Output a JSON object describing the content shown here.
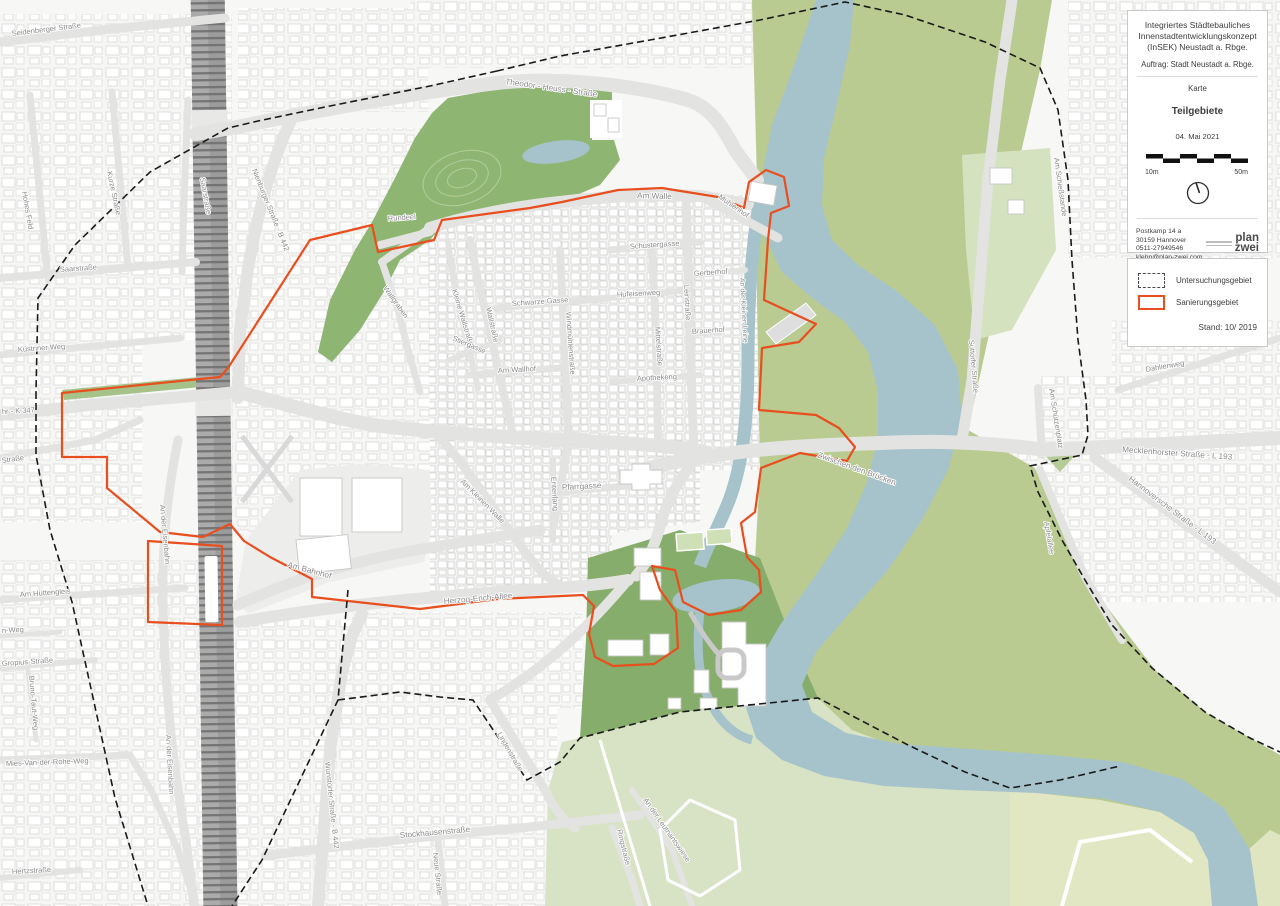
{
  "info_panel": {
    "title_line1": "Integriertes Städtebauliches",
    "title_line2": "Innenstadtentwicklungskonzept",
    "title_line3": "(InSEK) Neustadt a. Rbge.",
    "commission": "Auftrag: Stadt Neustadt a. Rbge.",
    "map_label": "Karte",
    "map_title": "Teilgebiete",
    "date": "04. Mai 2021",
    "scale_left": "10m",
    "scale_right": "50m",
    "address_line1": "Postkamp 14 a",
    "address_line2": "30159  Hannover",
    "address_line3": "0511-27949546",
    "address_line4": "klehn@plan-zwei.com",
    "logo_line1": "plan",
    "logo_line2": "zwei"
  },
  "legend": {
    "item1_label": "Untersuchungsgebiet",
    "item2_label": "Sanierungsgebiet",
    "status": "Stand: 10/ 2019"
  },
  "colors": {
    "sanierungsgebiet_red": "#e84e1e",
    "untersuchungsgebiet_black": "#1a1a1a",
    "park_green": "#8fb573",
    "floodplain_green": "#b9cb90",
    "pale_green": "#d8e3c5",
    "river_blue": "#a6c3cb",
    "street_gray": "#e3e3e2",
    "railway_gray": "#ababab"
  },
  "map": {
    "street_labels": [
      "Seidenberger Straße",
      "Hohes Feld",
      "Kurze Straße",
      "Saarstraße",
      "Saarstraße",
      "Nienburger Straße - B 442",
      "Theodor - Heuss - Straße",
      "Am Walle",
      "Mühlenhof",
      "Rundeel",
      "Wallgraben",
      "Kleine Wallstraße",
      "Wallstraße",
      "Stiergasse",
      "Schwarze Gasse",
      "Schustergasse",
      "Hufeisenweg",
      "Gerberhof",
      "Windmühlenstraße",
      "Mittelstraße",
      "Leinstraße",
      "Brauerhof",
      "An der Kleinen Leine",
      "Am Wallhof",
      "Apothekeng",
      "Zwischen den Brücken",
      "Am Kleinen Walle",
      "Entenfang",
      "Pfarrgasse",
      "Herzog-Erich-Allee",
      "Am Bahnhof",
      "An der Eisenbahn",
      "An der Eisenbahn",
      "Küstriner Weg",
      "hr - K 347",
      "Straße",
      "Am Hüttengleis",
      "n-Weg",
      "Gropius-Straße",
      "Bruno-Taut-Weg",
      "Mies-Van-der-Rohe-Weg",
      "Hertzstraße",
      "Wunstorfer Straße - B 442",
      "Stockhausenstraße",
      "Neue Straße",
      "Lindenstraße",
      "Ringstraße",
      "An der Leutnantswiese",
      "Suttorfer Straße",
      "Am Schießstande",
      "Dahlienweg",
      "Am Schützenplatz",
      "Mecklenhorster Straße - L 193",
      "Hannoversche Straße - L 193",
      "Apfelallee"
    ]
  }
}
